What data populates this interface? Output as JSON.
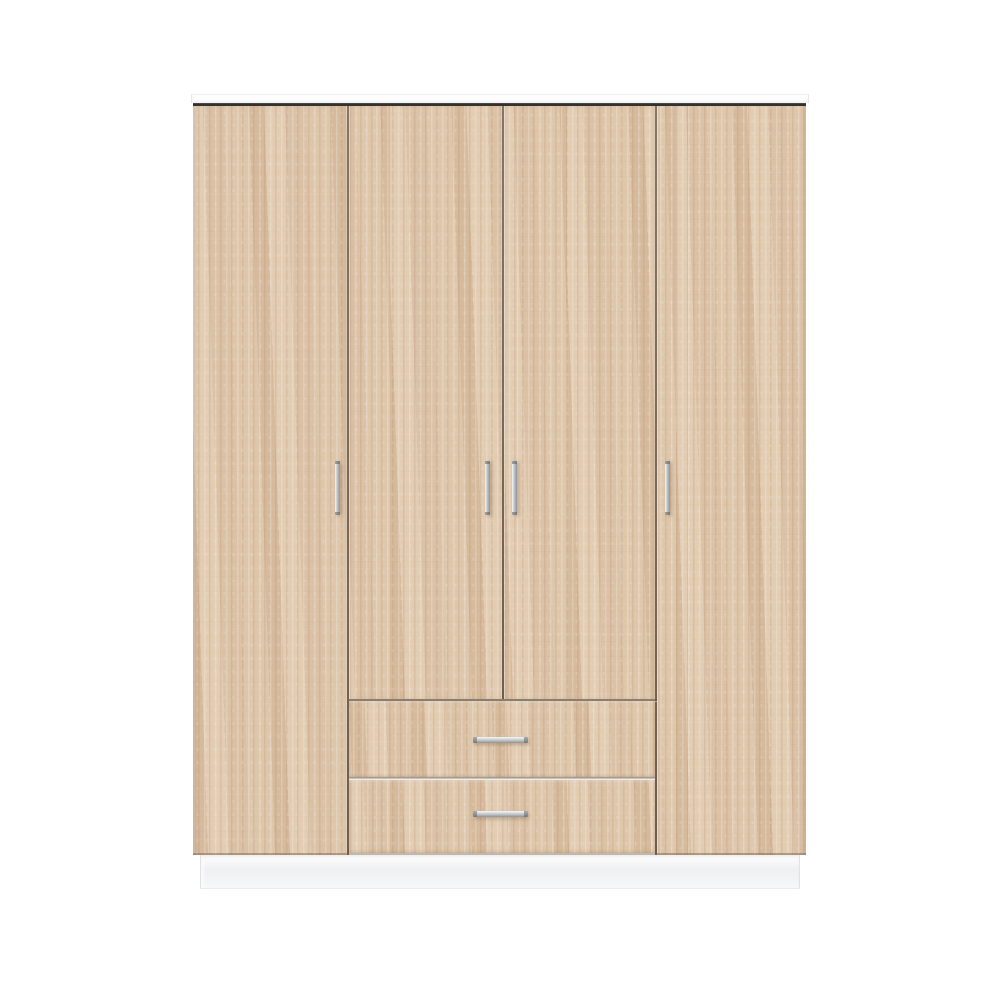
{
  "scene": {
    "type": "product-photo",
    "subject": "Four-door wardrobe with two center drawers",
    "material": "light sonoma oak woodgrain laminate",
    "background_description": "plain white studio backdrop",
    "doors_count": 4,
    "drawers_count": 2,
    "door_handle_style": "slim vertical brushed-metal bar",
    "drawer_handle_style": "horizontal brushed-metal bar",
    "top_style": "white carcass top edge with dark shadow reveal",
    "base_style": "recessed white plinth"
  },
  "colors": {
    "background": "#ffffff",
    "wood_base": "#dcc3a8",
    "wood_light_streak": "#eedfc8",
    "wood_dark_streak": "#c7a683",
    "top_panel": "#fcfcfc",
    "top_panel_edge": "#e8e8e8",
    "top_line": "#2e2c2a",
    "gap_line": "#6f5d4b",
    "handle_hi": "#f5f6f6",
    "handle_mid": "#c2c5c7",
    "handle_lo": "#8e9294",
    "plinth_top": "#ffffff",
    "plinth_mid": "#eff0f2",
    "plinth_edge": "#e1e2e5"
  }
}
